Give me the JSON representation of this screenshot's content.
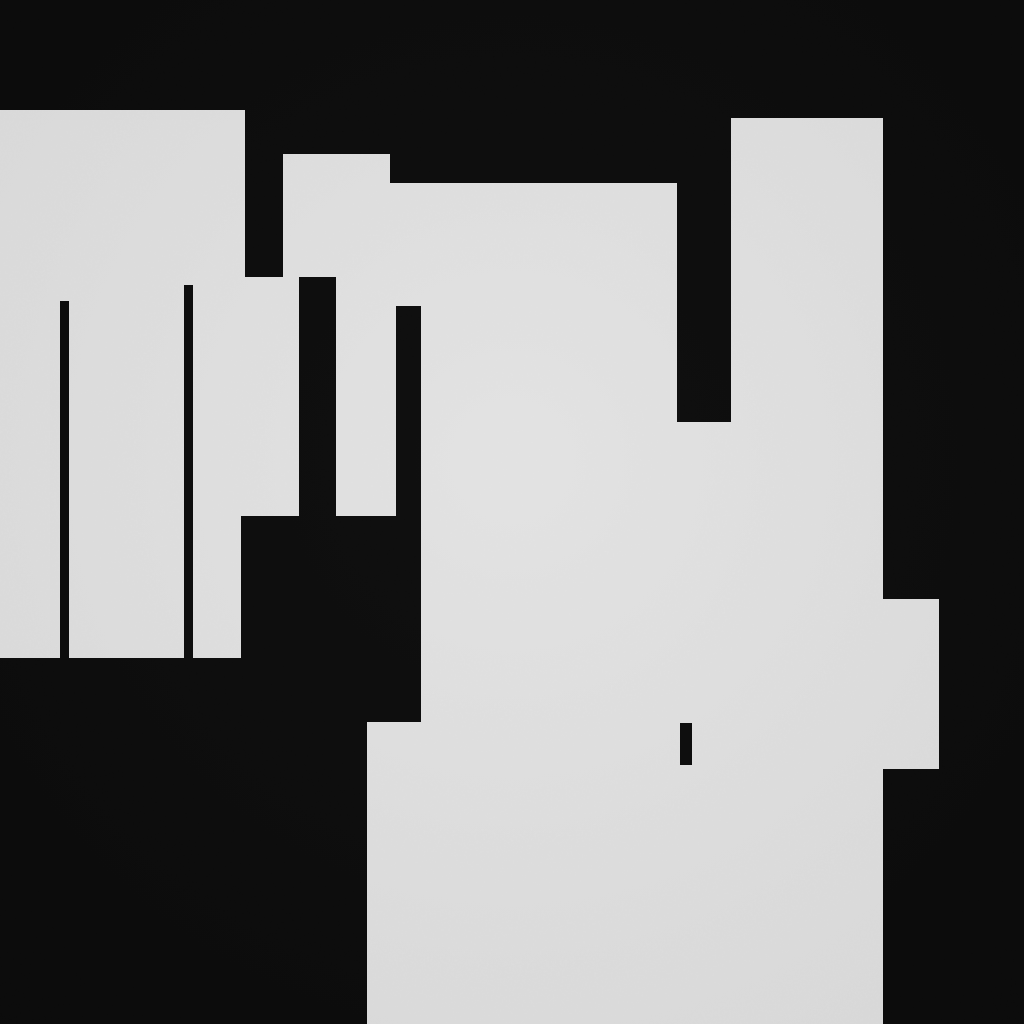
{
  "canvas": {
    "width": 1024,
    "height": 1024,
    "description": "abstract monochrome blocky composition: light gray paper-textured rectangular regions on a near-black background with thin black vertical marks"
  },
  "palette": {
    "background": "#0b0b0b",
    "surface": "#e2e2e2"
  },
  "shapes": {
    "light_regions": [
      {
        "name": "left-block-upper",
        "x": 0,
        "y": 110,
        "w": 245,
        "h": 406
      },
      {
        "name": "left-block-lower",
        "x": 0,
        "y": 516,
        "w": 241,
        "h": 142
      },
      {
        "name": "left-connector",
        "x": 245,
        "y": 277,
        "w": 38,
        "h": 239
      },
      {
        "name": "middle-block",
        "x": 283,
        "y": 154,
        "w": 107,
        "h": 362
      },
      {
        "name": "center-top-region",
        "x": 390,
        "y": 183,
        "w": 287,
        "h": 333
      },
      {
        "name": "notch-underfill",
        "x": 677,
        "y": 422,
        "w": 54,
        "h": 94
      },
      {
        "name": "right-tall-region",
        "x": 731,
        "y": 118,
        "w": 152,
        "h": 398
      },
      {
        "name": "bottom-center-region",
        "x": 421,
        "y": 516,
        "w": 462,
        "h": 508
      },
      {
        "name": "bottom-left-step",
        "x": 367,
        "y": 722,
        "w": 54,
        "h": 302
      },
      {
        "name": "right-bump",
        "x": 883,
        "y": 599,
        "w": 56,
        "h": 170
      }
    ],
    "dark_marks": [
      {
        "name": "thin-vertical-line-left",
        "x": 60,
        "y": 301,
        "w": 9,
        "h": 357
      },
      {
        "name": "thin-vertical-line-middle",
        "x": 184,
        "y": 285,
        "w": 9,
        "h": 373
      },
      {
        "name": "wide-vertical-column",
        "x": 299,
        "y": 277,
        "w": 37,
        "h": 239
      },
      {
        "name": "narrow-vertical-column",
        "x": 396,
        "y": 306,
        "w": 25,
        "h": 210
      },
      {
        "name": "small-vertical-tick",
        "x": 680,
        "y": 723,
        "w": 12,
        "h": 42
      }
    ]
  }
}
